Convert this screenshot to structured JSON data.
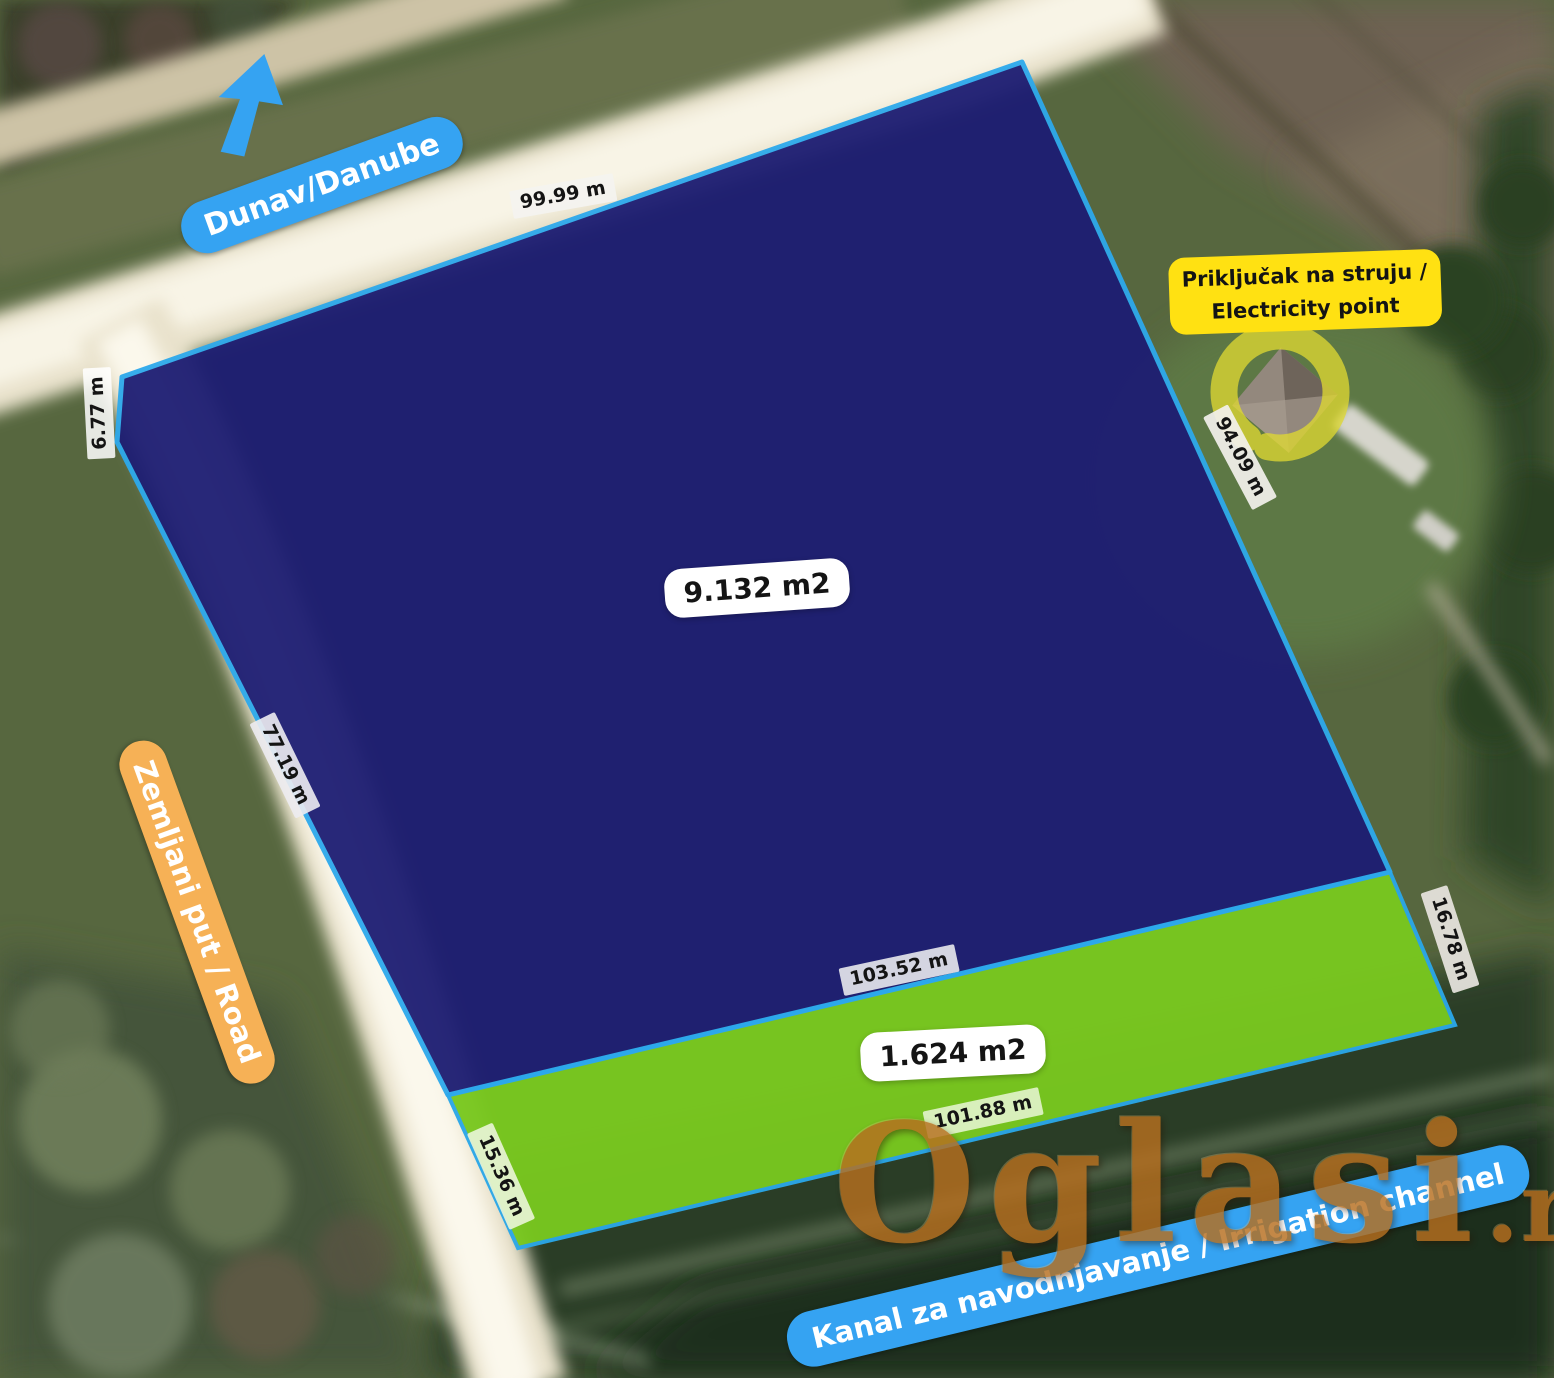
{
  "labels": {
    "danube": "Dunav/Danube",
    "road": "Zemljani put / Road",
    "channel": "Kanal za navodnjavanje / Irrigation channel",
    "electricity_line1": "Priključak na struju /",
    "electricity_line2": "Electricity point",
    "area_blue_parcel": "9.132 m2",
    "area_green_parcel": "1.624 m2",
    "side_top": "99.99 m",
    "side_bevel": "6.77 m",
    "side_west": "77.19 m",
    "side_east": "94.09 m",
    "side_middle": "103.52 m",
    "side_bottom": "101.88 m",
    "side_green_west": "15.36 m",
    "side_green_east": "16.78 m"
  },
  "watermark": {
    "name": "Oglasi",
    "tld": ".rs"
  },
  "colors": {
    "parcel_blue": "#1d1d73",
    "parcel_green": "#79c81f",
    "parcel_outline": "#2ba7e8",
    "annotation_blue": "#35a3f2",
    "annotation_orange": "#f6b156",
    "annotation_yellow": "#ffe112",
    "ring_yellow": "#ded732",
    "watermark_bronze": "#b76f1f"
  }
}
